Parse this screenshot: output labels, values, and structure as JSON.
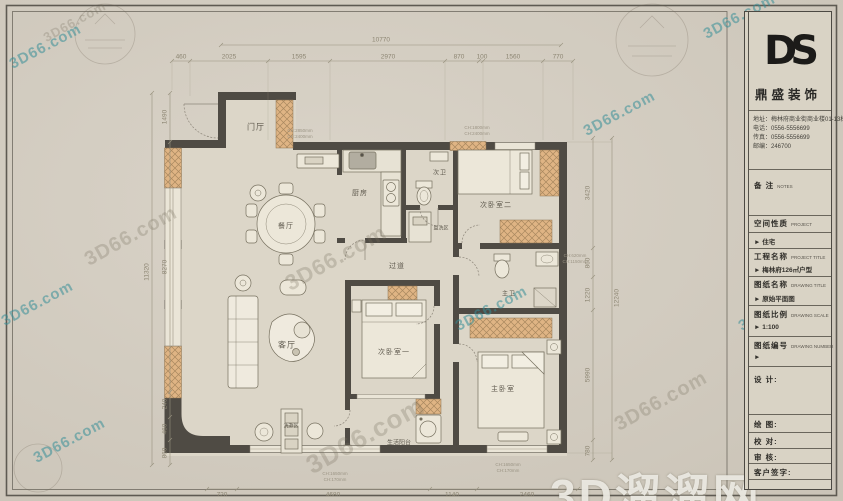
{
  "watermark": {
    "site": "3D66.com",
    "brand": "3D溜溜网"
  },
  "title_block": {
    "logo": "DS",
    "company": "鼎盛装饰",
    "address": "地址：梅林府商业街商业楼01-13栋",
    "phone": "电话：0556-5556699",
    "fax": "传真：0556-5556699",
    "postcode": "邮编：246700",
    "notes_cn": "备 注",
    "notes_en": "NOTES",
    "space_cn": "空间性质",
    "space_en": "PROJECT",
    "space_val": "► 住宅",
    "project_cn": "工程名称",
    "project_en": "PROJECT TITLE",
    "project_val": "► 梅林府126㎡户型",
    "drawing_cn": "图纸名称",
    "drawing_en": "DRAWING TITLE",
    "drawing_val": "► 原始平面图",
    "scale_cn": "图纸比例",
    "scale_en": "DRAWING SCALE",
    "scale_val": "► 1:100",
    "number_cn": "图纸编号",
    "number_en": "DRAWING NUMBER",
    "number_val": "►",
    "design": "设 计:",
    "draw": "绘 图:",
    "check": "校 对:",
    "review": "审 核:",
    "client": "客户签字:"
  },
  "rooms": {
    "entry": "门厅",
    "dining": "餐厅",
    "kitchen": "厨房",
    "bath2": "次卫",
    "bed2": "次卧室二",
    "wash": "盥洗区",
    "hall": "过道",
    "living": "客厅",
    "bed1": "次卧室一",
    "mbath": "主卫",
    "mbed": "主卧室",
    "balcony": "生活阳台",
    "laundry": "洗漱区"
  },
  "dims": {
    "top_total": "10770",
    "top": [
      "460",
      "2025",
      "1595",
      "2970",
      "870",
      "100",
      "1560",
      "770"
    ],
    "left_total": "11320",
    "left": [
      "1490",
      "8270",
      "240",
      "460",
      "860"
    ],
    "right_total": "12240",
    "right": [
      "3420",
      "860",
      "1220",
      "5990",
      "780"
    ],
    "bottom": [
      "720",
      "4680",
      "1140",
      "2460"
    ]
  },
  "annotations": {
    "a1": "CH:2850mm\nCH:2400mm",
    "a2": "CH:1800mm\nCH:2400mm",
    "a3": "CH:1650mm\nCH:170mm",
    "a4": "CH:1650mm\nCH:170mm",
    "a5": "CH:620mm\nCH:1150mm"
  }
}
